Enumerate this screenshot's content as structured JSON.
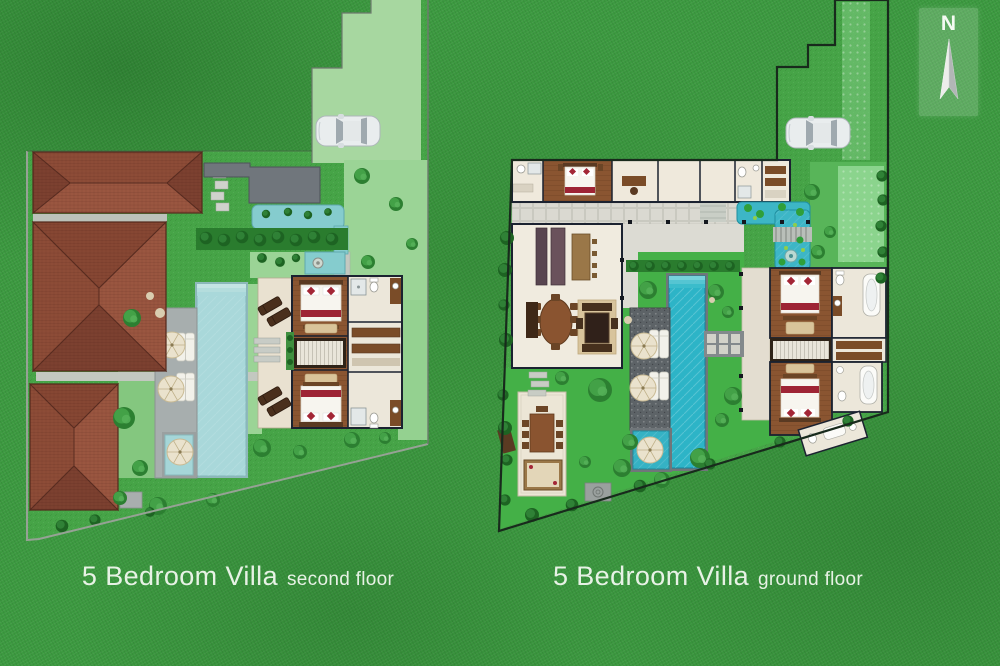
{
  "canvas": {
    "width": 1000,
    "height": 666,
    "grass_color": "#3c9a40"
  },
  "compass": {
    "letter": "N",
    "icon": "north-arrow-icon"
  },
  "labels": {
    "left": {
      "title": "5 Bedroom Villa",
      "subtitle": "second floor"
    },
    "right": {
      "title": "5 Bedroom Villa",
      "subtitle": "ground floor"
    }
  },
  "colors": {
    "grass": "#3c9a40",
    "plan_lawn": "#46a447",
    "lawn_light": "#9bd496",
    "driveway_light": "#a7d7a0",
    "roof_tile": "#91503a",
    "roof_flat_gray": "#70767c",
    "pool_pale": "#a9d8da",
    "pool_vivid": "#2db4c7",
    "water_feature": "#3db6c6",
    "deck_dark": "#5d6367",
    "paver_light": "#d7d7cf",
    "wood_floor": "#8a5531",
    "tile_floor": "#ece7da",
    "terrace_cream": "#e9e1d0",
    "bed_linen": "#f7f5ef",
    "bed_accent_red": "#9e2435",
    "hedge_green": "#2a7c2e",
    "wall_dark": "#1b2230",
    "label_text": "#e7f2e5",
    "car_body": "#e9edee",
    "umbrella_cream": "#eae2cd"
  },
  "plans": {
    "left": {
      "name": "5-bedroom-villa-second-floor",
      "elements": [
        "hip-roof",
        "hip-roof",
        "hip-roof",
        "flat-roof",
        "water-garden",
        "hedge",
        "swimming-pool",
        "kids-pool",
        "sun-loungers",
        "umbrellas",
        "bedroom",
        "bedroom",
        "bathroom",
        "wardrobe",
        "staircase",
        "balcony-terrace",
        "driveway",
        "car"
      ]
    },
    "right": {
      "name": "5-bedroom-villa-ground-floor",
      "elements": [
        "bedroom",
        "bedroom",
        "bedroom",
        "bathroom",
        "bathroom",
        "bathroom",
        "kitchen",
        "dining-table",
        "living-lounge",
        "courtyard-garden",
        "koi-pond",
        "swimming-pool",
        "kids-pool",
        "sun-loungers",
        "umbrellas",
        "staircase",
        "dining-pavilion",
        "driveway",
        "car"
      ]
    }
  }
}
